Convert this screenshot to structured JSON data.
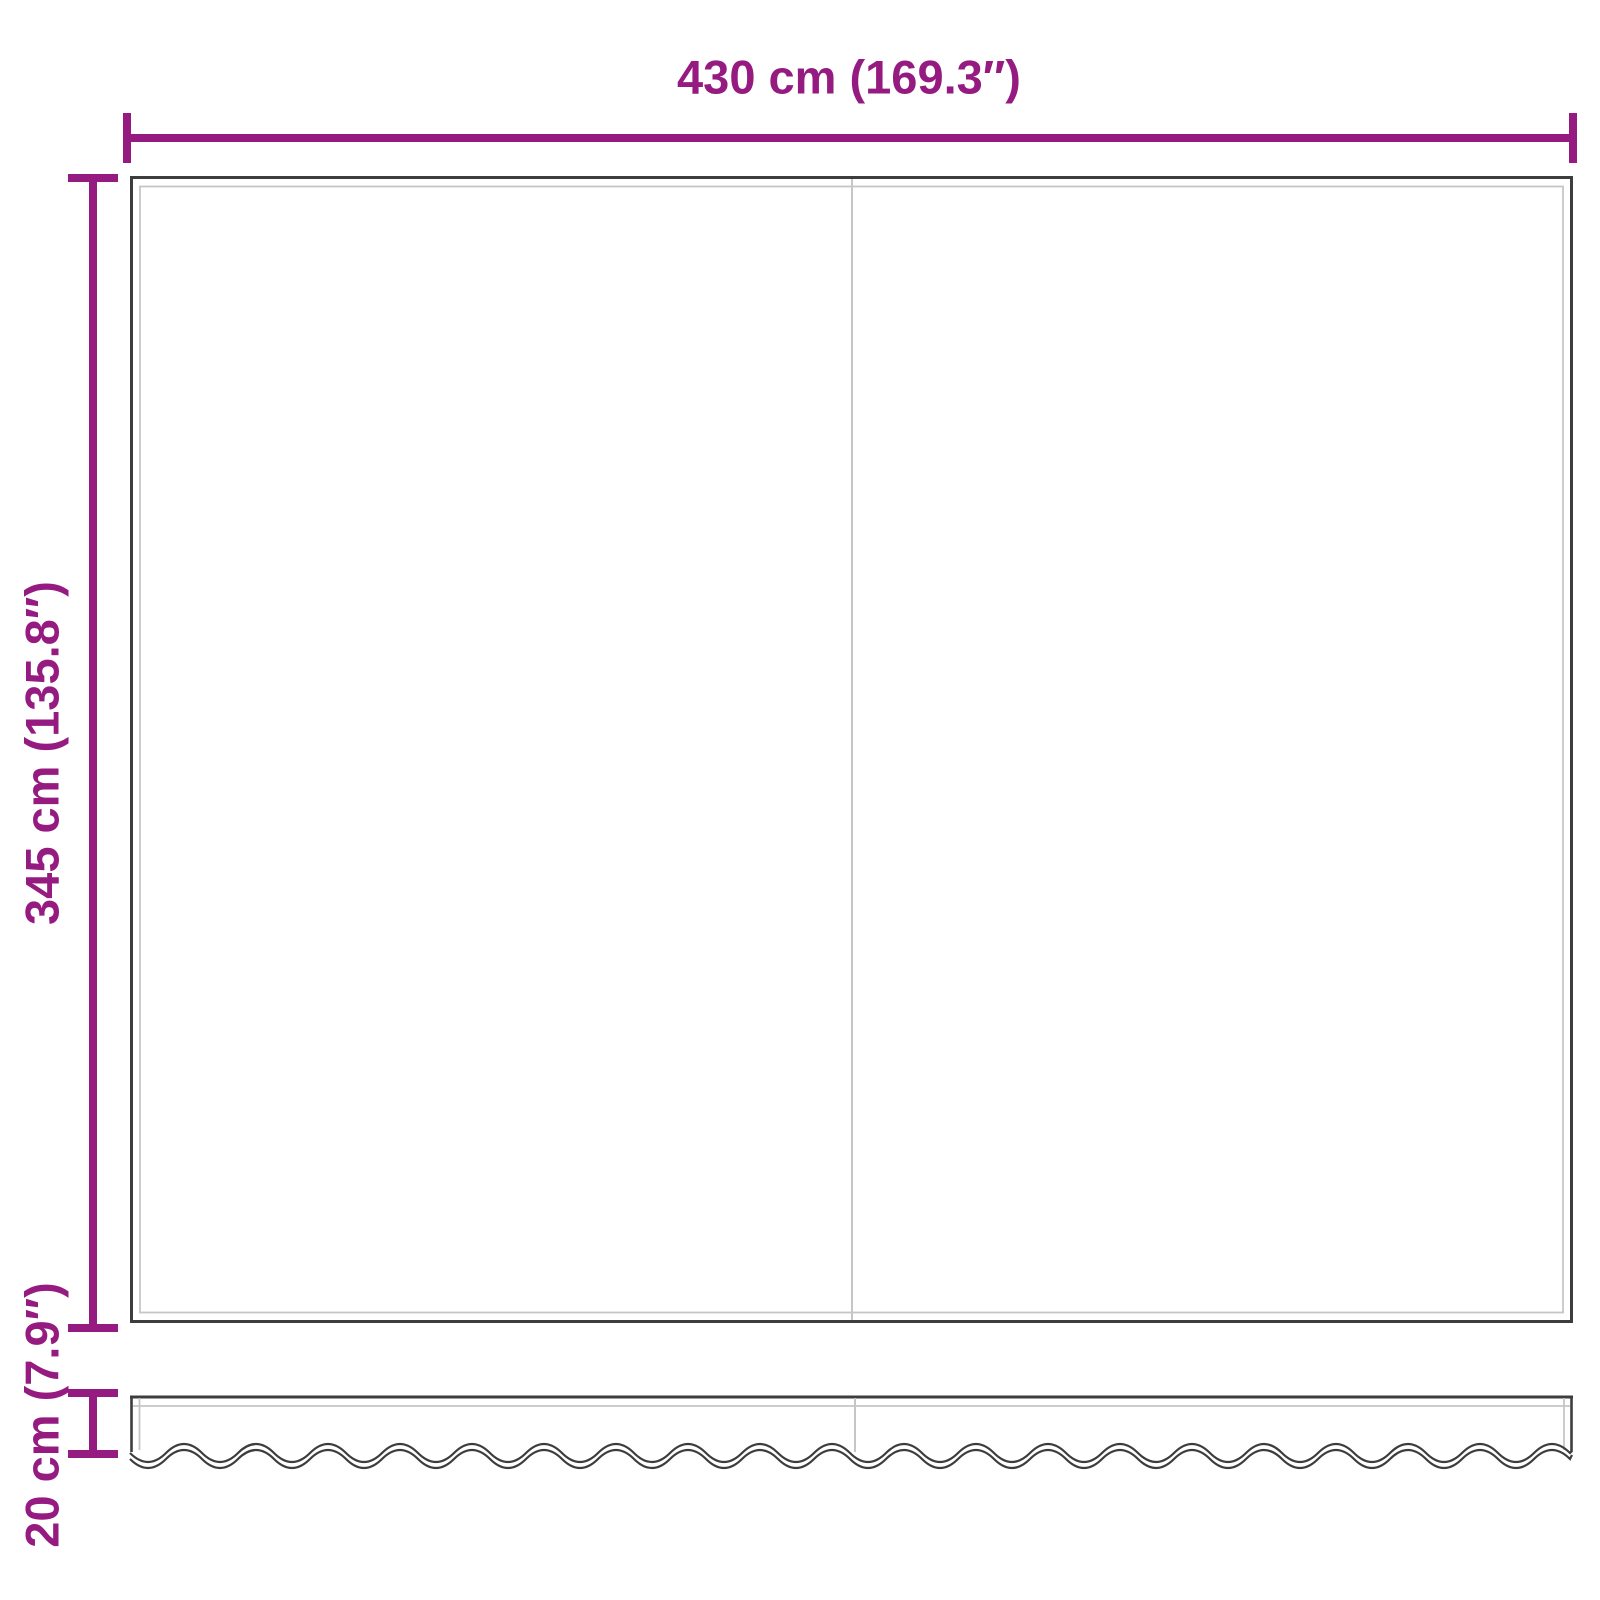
{
  "colors": {
    "dimension": "#951b81",
    "panel_outline": "#3d3d3d",
    "panel_inner_line": "#c6c6c6",
    "background": "#ffffff"
  },
  "diagram": {
    "width_dimension": {
      "label": "430 cm (169.3″)"
    },
    "height_dimension": {
      "label": "345 cm (135.8″)"
    },
    "valance_dimension": {
      "label": "20 cm (7.9″)"
    }
  }
}
